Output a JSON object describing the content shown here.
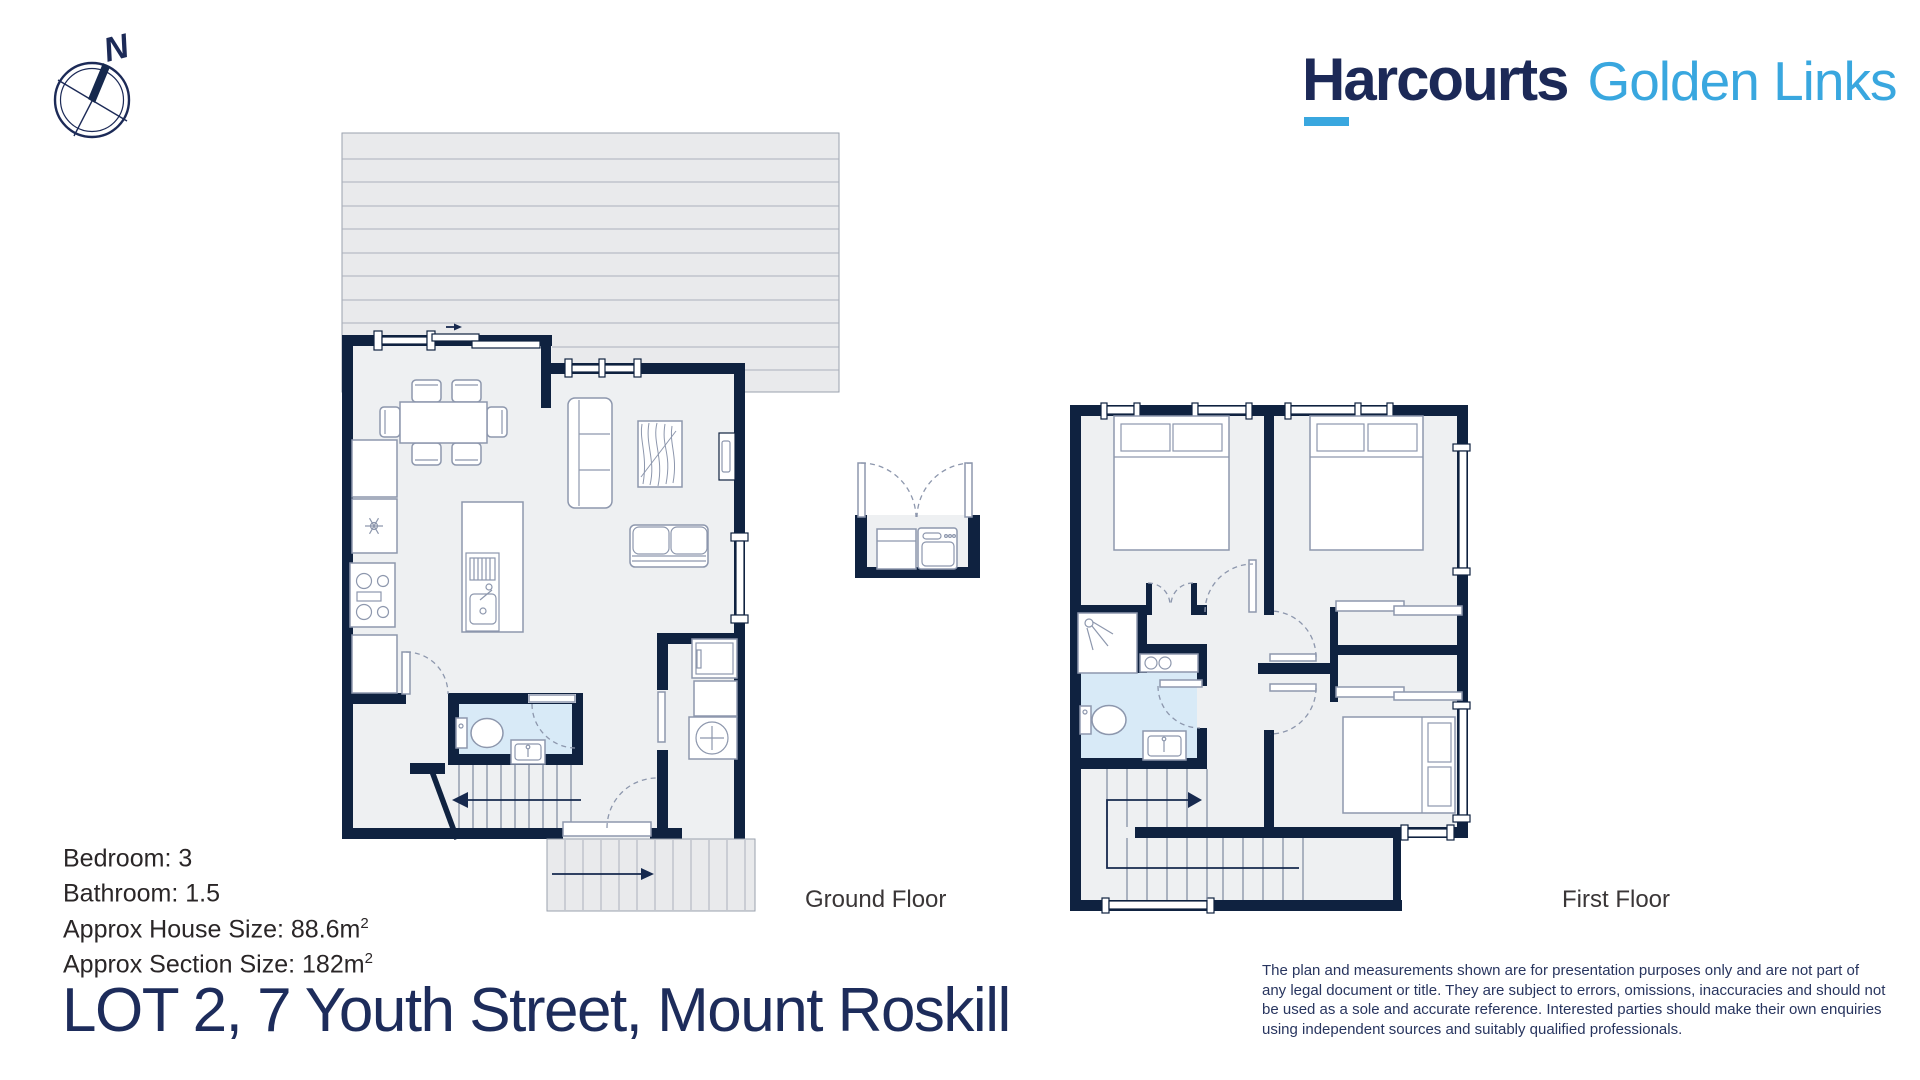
{
  "brand": {
    "word_h": "H",
    "word_rest": "arcourts",
    "word_full": "Harcourts",
    "office": "Golden Links",
    "color_navy": "#1c2957",
    "color_blue": "#39a7df"
  },
  "compass": {
    "label": "N"
  },
  "plans": {
    "ground_label": "Ground Floor",
    "first_label": "First Floor"
  },
  "details": {
    "lines": [
      {
        "text": "Bedroom: 3",
        "sup": ""
      },
      {
        "text": "Bathroom: 1.5",
        "sup": ""
      },
      {
        "text": "Approx House Size: 88.6m",
        "sup": "2"
      },
      {
        "text": "Approx Section Size: 182m",
        "sup": "2"
      }
    ]
  },
  "address": {
    "title": "LOT 2, 7 Youth Street, Mount Roskill"
  },
  "disclaimer": {
    "text": "The plan and measurements shown are for presentation purposes only and are not part of any legal document or title. They are subject to errors, omissions, inaccuracies and should not be used as a sole and accurate reference. Interested parties should make their own enquiries using independent sources and suitably qualified professionals."
  },
  "colors": {
    "wall": "#0f2240",
    "floor_fill": "#eef0f2",
    "deck_fill": "#e9eaec",
    "bathroom_fill": "#d8eaf7",
    "fixture_stroke": "#8d97ad",
    "accent_blue": "#39a7df",
    "navy_text": "#1c2957"
  }
}
